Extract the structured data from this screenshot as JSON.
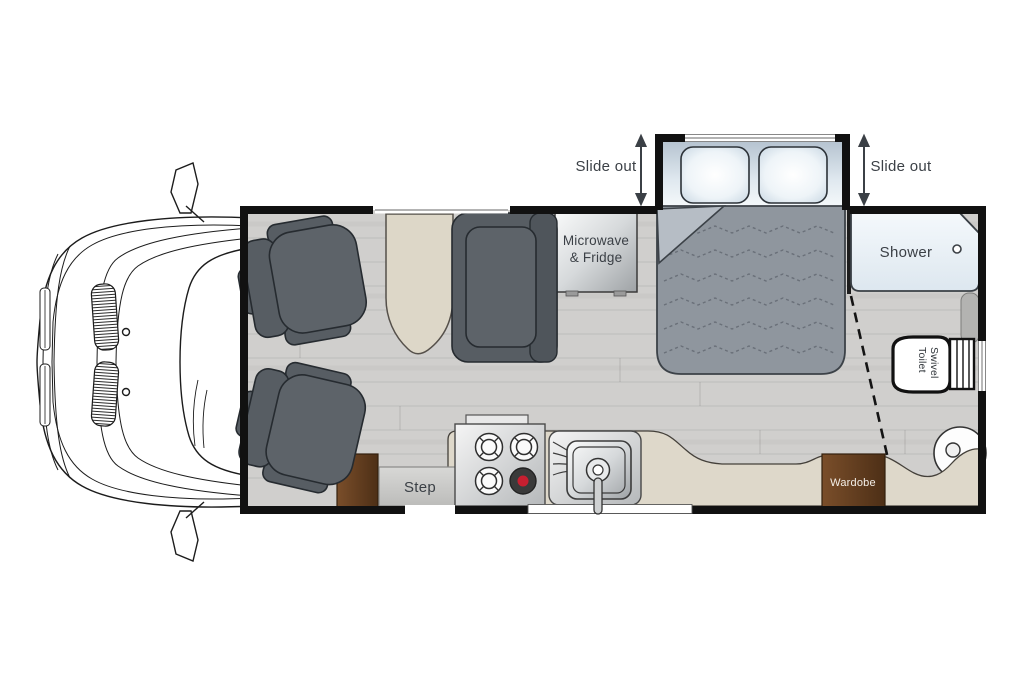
{
  "floorplan": {
    "type": "rv-motorhome-top-view",
    "labels": {
      "slide_out_left": "Slide out",
      "slide_out_right": "Slide out",
      "microwave_line1": "Microwave",
      "microwave_line2": "& Fridge",
      "shower": "Shower",
      "toilet_line1": "Swivel",
      "toilet_line2": "Toilet",
      "step": "Step",
      "wardrobe": "Wardobe"
    },
    "colors": {
      "wall": "#111111",
      "floor_wood": "#d0cfcd",
      "upholstery_gray": "#5d6369",
      "mattress_gray": "#8f969e",
      "counter_cream": "#ded8ca",
      "cabinet_brown": "#5f3a1d",
      "metallic_light": "#f2f3f4",
      "metallic_dark": "#a3a7aa",
      "pillow_blue": "#cfdce7",
      "label_text": "#3b4046",
      "burner_red": "#c61f30"
    }
  }
}
